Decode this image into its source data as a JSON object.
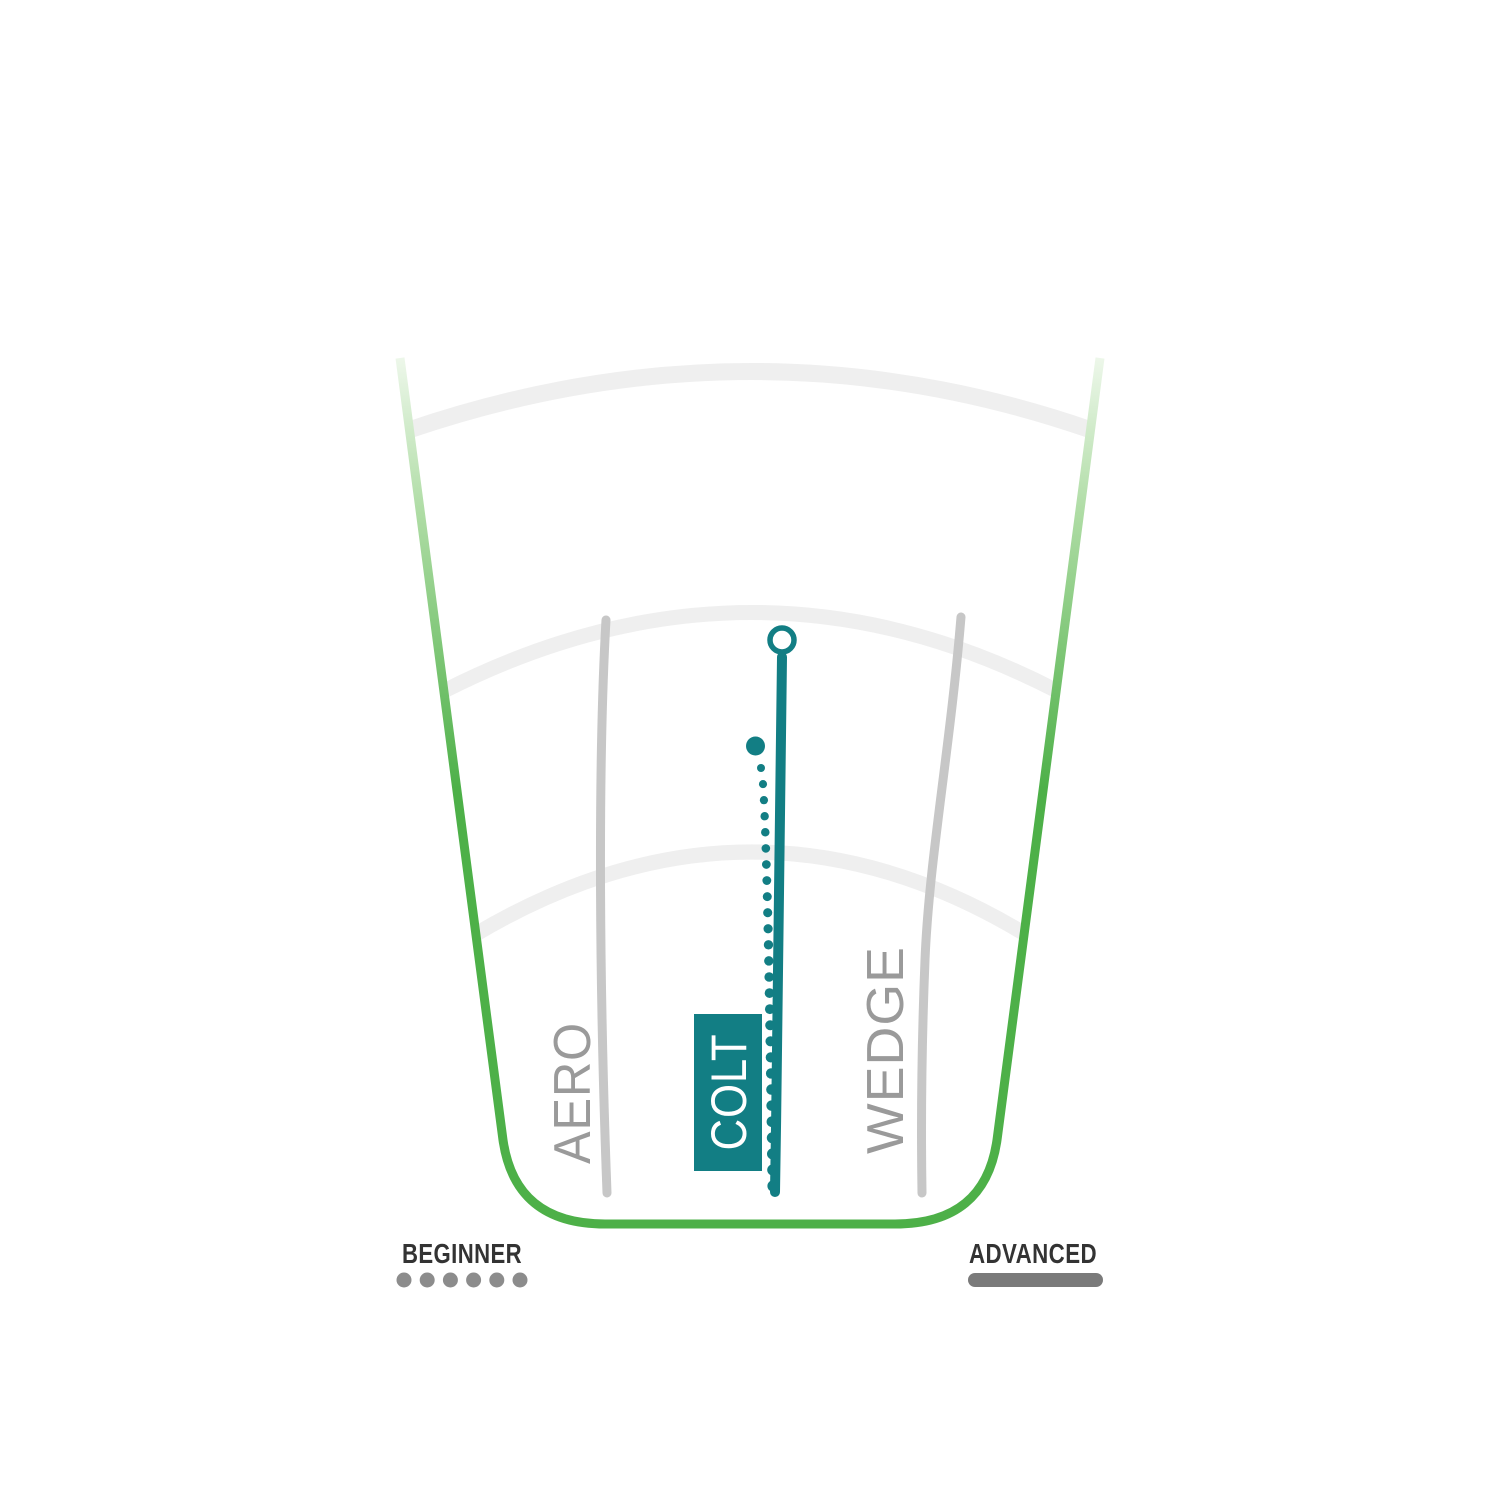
{
  "labels": {
    "beginner": "BEGINNER",
    "advanced": "ADVANCED"
  },
  "discs": [
    {
      "name": "AERO",
      "highlighted": false
    },
    {
      "name": "COLT",
      "highlighted": true
    },
    {
      "name": "WEDGE",
      "highlighted": false
    }
  ],
  "colors": {
    "teal": "#127E84",
    "green": "#4DB048",
    "green_light": "#AEDCA4",
    "green_pale": "#EDF7EA",
    "arc_gray": "#EFEFEF",
    "path_gray": "#C7C7C7",
    "label_gray": "#9A9A9A",
    "ink": "#333333",
    "dot_gray": "#8C8C8C",
    "bar_gray": "#7A7A7A"
  },
  "chart_data": {
    "type": "line",
    "title": "",
    "description": "Disc golf flight-path comparison chart inside a fan-shaped fairway. Paths run from release (bottom) to landing (top). Horizontal position maps player skill from BEGINNER (left, dotted marker) to ADVANCED (right, solid marker). The COLT disc is highlighted in teal with a solid main flight line ending in an open-circle landing marker and a dotted secondary flight line to its left. Three light gray arcs are distance rings.",
    "x_axis": {
      "left_label": "BEGINNER",
      "right_label": "ADVANCED",
      "range_pct": [
        0,
        100
      ]
    },
    "y_axis": {
      "label": "distance",
      "range_pct": [
        0,
        100
      ]
    },
    "distance_rings_pct": [
      43,
      71,
      98
    ],
    "grid": "arcs",
    "legend": {
      "beginner_marker": "dotted-line",
      "advanced_marker": "solid-line"
    },
    "series": [
      {
        "name": "AERO",
        "color": "#C7C7C7",
        "style": "solid",
        "highlighted": false,
        "points_pct": [
          [
            29.7,
            3.6
          ],
          [
            28.4,
            37.0
          ],
          [
            29.4,
            69.8
          ]
        ]
      },
      {
        "name": "COLT",
        "color": "#127E84",
        "style": "solid",
        "highlighted": true,
        "points_pct": [
          [
            53.6,
            3.7
          ],
          [
            54.0,
            35.0
          ],
          [
            54.6,
            65.5
          ]
        ],
        "landing_marker_pct": [
          54.6,
          67.4
        ]
      },
      {
        "name": "COLT dotted",
        "color": "#127E84",
        "style": "dotted",
        "highlighted": true,
        "points_pct": [
          [
            53.3,
            4.4
          ],
          [
            51.6,
            30.0
          ],
          [
            50.8,
            55.2
          ]
        ]
      },
      {
        "name": "WEDGE",
        "color": "#C7C7C7",
        "style": "solid",
        "highlighted": false,
        "points_pct": [
          [
            74.6,
            3.6
          ],
          [
            75.0,
            38.0
          ],
          [
            80.1,
            70.2
          ]
        ]
      }
    ]
  }
}
